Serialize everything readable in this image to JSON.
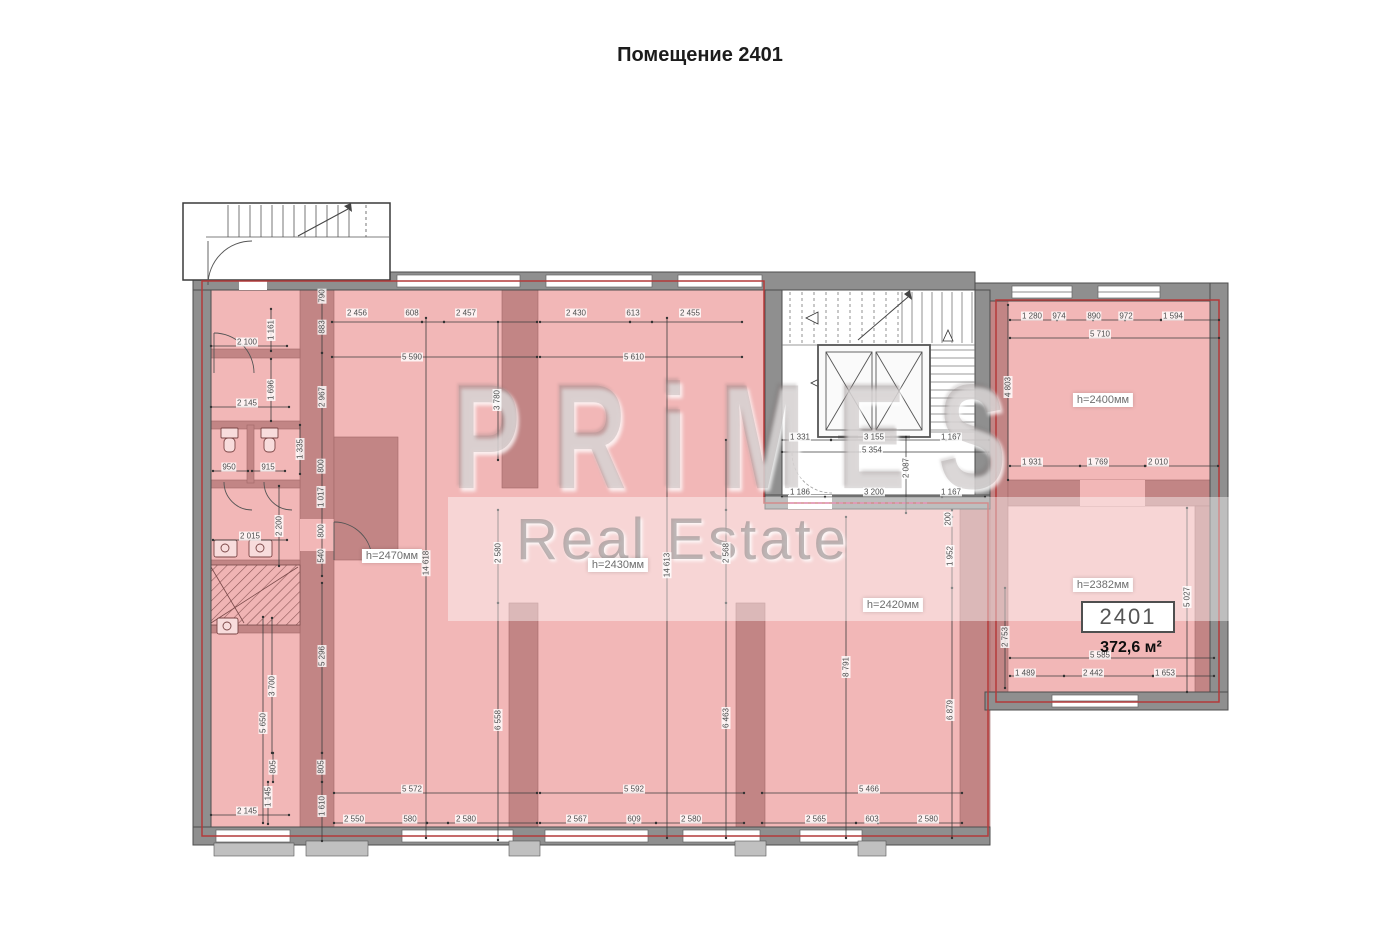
{
  "title": "Помещение 2401",
  "unit": {
    "number": "2401",
    "area": "372,6 м²"
  },
  "watermark": {
    "line1": "PRiMES",
    "line2": "Real Estate"
  },
  "colors": {
    "floor_pink": "#f2b7b7",
    "wall_pink": "#c28585",
    "wall_gray": "#8f8f8f",
    "boundary_red": "#b43a3a",
    "dashed_magenta": "#d4508c"
  },
  "room_heights": [
    {
      "t": "h=2470мм",
      "x": 392,
      "y": 556
    },
    {
      "t": "h=2430мм",
      "x": 618,
      "y": 565
    },
    {
      "t": "h=2420мм",
      "x": 893,
      "y": 605
    },
    {
      "t": "h=2400мм",
      "x": 1103,
      "y": 400
    },
    {
      "t": "h=2382мм",
      "x": 1103,
      "y": 585
    }
  ],
  "dimensions": [
    {
      "t": "2 456",
      "x": 357,
      "y": 313
    },
    {
      "t": "608",
      "x": 412,
      "y": 313
    },
    {
      "t": "2 457",
      "x": 466,
      "y": 313
    },
    {
      "t": "5 590",
      "x": 412,
      "y": 357
    },
    {
      "t": "2 430",
      "x": 576,
      "y": 313
    },
    {
      "t": "613",
      "x": 633,
      "y": 313
    },
    {
      "t": "2 455",
      "x": 690,
      "y": 313
    },
    {
      "t": "5 610",
      "x": 634,
      "y": 357
    },
    {
      "t": "1 280",
      "x": 1032,
      "y": 316
    },
    {
      "t": "974",
      "x": 1059,
      "y": 316
    },
    {
      "t": "890",
      "x": 1094,
      "y": 316
    },
    {
      "t": "972",
      "x": 1126,
      "y": 316
    },
    {
      "t": "1 594",
      "x": 1173,
      "y": 316
    },
    {
      "t": "5 710",
      "x": 1100,
      "y": 334
    },
    {
      "t": "790",
      "x": 322,
      "y": 296,
      "r": 1
    },
    {
      "t": "883",
      "x": 322,
      "y": 327,
      "r": 1
    },
    {
      "t": "2 967",
      "x": 322,
      "y": 397,
      "r": 1
    },
    {
      "t": "1 161",
      "x": 271,
      "y": 330,
      "r": 1
    },
    {
      "t": "2 100",
      "x": 247,
      "y": 342
    },
    {
      "t": "1 696",
      "x": 271,
      "y": 390,
      "r": 1
    },
    {
      "t": "2 145",
      "x": 247,
      "y": 403
    },
    {
      "t": "1 335",
      "x": 300,
      "y": 449,
      "r": 1
    },
    {
      "t": "950",
      "x": 229,
      "y": 467
    },
    {
      "t": "915",
      "x": 268,
      "y": 467
    },
    {
      "t": "800",
      "x": 321,
      "y": 466,
      "r": 1
    },
    {
      "t": "1 017",
      "x": 321,
      "y": 497,
      "r": 1
    },
    {
      "t": "800",
      "x": 321,
      "y": 531,
      "r": 1
    },
    {
      "t": "540",
      "x": 321,
      "y": 556,
      "r": 1
    },
    {
      "t": "2 200",
      "x": 279,
      "y": 526,
      "r": 1
    },
    {
      "t": "2 015",
      "x": 250,
      "y": 536
    },
    {
      "t": "5 296",
      "x": 322,
      "y": 656,
      "r": 1
    },
    {
      "t": "3 700",
      "x": 272,
      "y": 686,
      "r": 1
    },
    {
      "t": "5 650",
      "x": 263,
      "y": 723,
      "r": 1
    },
    {
      "t": "805",
      "x": 273,
      "y": 767,
      "r": 1
    },
    {
      "t": "805",
      "x": 321,
      "y": 767,
      "r": 1
    },
    {
      "t": "1 145",
      "x": 268,
      "y": 797,
      "r": 1
    },
    {
      "t": "1 610",
      "x": 322,
      "y": 806,
      "r": 1
    },
    {
      "t": "2 145",
      "x": 247,
      "y": 811
    },
    {
      "t": "5 572",
      "x": 412,
      "y": 789
    },
    {
      "t": "2 550",
      "x": 354,
      "y": 819
    },
    {
      "t": "580",
      "x": 410,
      "y": 819
    },
    {
      "t": "2 580",
      "x": 466,
      "y": 819
    },
    {
      "t": "5 592",
      "x": 634,
      "y": 789
    },
    {
      "t": "2 567",
      "x": 577,
      "y": 819
    },
    {
      "t": "609",
      "x": 634,
      "y": 819
    },
    {
      "t": "2 580",
      "x": 691,
      "y": 819
    },
    {
      "t": "5 466",
      "x": 869,
      "y": 789
    },
    {
      "t": "2 565",
      "x": 816,
      "y": 819
    },
    {
      "t": "603",
      "x": 872,
      "y": 819
    },
    {
      "t": "2 580",
      "x": 928,
      "y": 819
    },
    {
      "t": "14 618",
      "x": 426,
      "y": 563,
      "r": 1
    },
    {
      "t": "2 580",
      "x": 498,
      "y": 553,
      "r": 1
    },
    {
      "t": "6 558",
      "x": 498,
      "y": 720,
      "r": 1
    },
    {
      "t": "3 780",
      "x": 497,
      "y": 400,
      "r": 1
    },
    {
      "t": "14 613",
      "x": 667,
      "y": 565,
      "r": 1
    },
    {
      "t": "2 568",
      "x": 726,
      "y": 553,
      "r": 1
    },
    {
      "t": "6 463",
      "x": 726,
      "y": 718,
      "r": 1
    },
    {
      "t": "8 791",
      "x": 846,
      "y": 667,
      "r": 1
    },
    {
      "t": "200",
      "x": 948,
      "y": 519,
      "r": 1
    },
    {
      "t": "1 952",
      "x": 950,
      "y": 556,
      "r": 1
    },
    {
      "t": "6 879",
      "x": 950,
      "y": 710,
      "r": 1
    },
    {
      "t": "2 753",
      "x": 1005,
      "y": 637,
      "r": 1
    },
    {
      "t": "5 027",
      "x": 1187,
      "y": 597,
      "r": 1
    },
    {
      "t": "4 803",
      "x": 1008,
      "y": 387,
      "r": 1
    },
    {
      "t": "2 087",
      "x": 906,
      "y": 468,
      "r": 1
    },
    {
      "t": "1 331",
      "x": 800,
      "y": 437
    },
    {
      "t": "3 155",
      "x": 874,
      "y": 437
    },
    {
      "t": "1 167",
      "x": 951,
      "y": 437
    },
    {
      "t": "5 354",
      "x": 872,
      "y": 450
    },
    {
      "t": "1 186",
      "x": 800,
      "y": 492
    },
    {
      "t": "3 200",
      "x": 874,
      "y": 492
    },
    {
      "t": "1 167",
      "x": 951,
      "y": 492
    },
    {
      "t": "1 931",
      "x": 1032,
      "y": 462
    },
    {
      "t": "1 769",
      "x": 1098,
      "y": 462
    },
    {
      "t": "2 010",
      "x": 1158,
      "y": 462
    },
    {
      "t": "5 585",
      "x": 1100,
      "y": 655
    },
    {
      "t": "1 489",
      "x": 1025,
      "y": 673
    },
    {
      "t": "2 442",
      "x": 1093,
      "y": 673
    },
    {
      "t": "1 653",
      "x": 1165,
      "y": 673
    }
  ]
}
